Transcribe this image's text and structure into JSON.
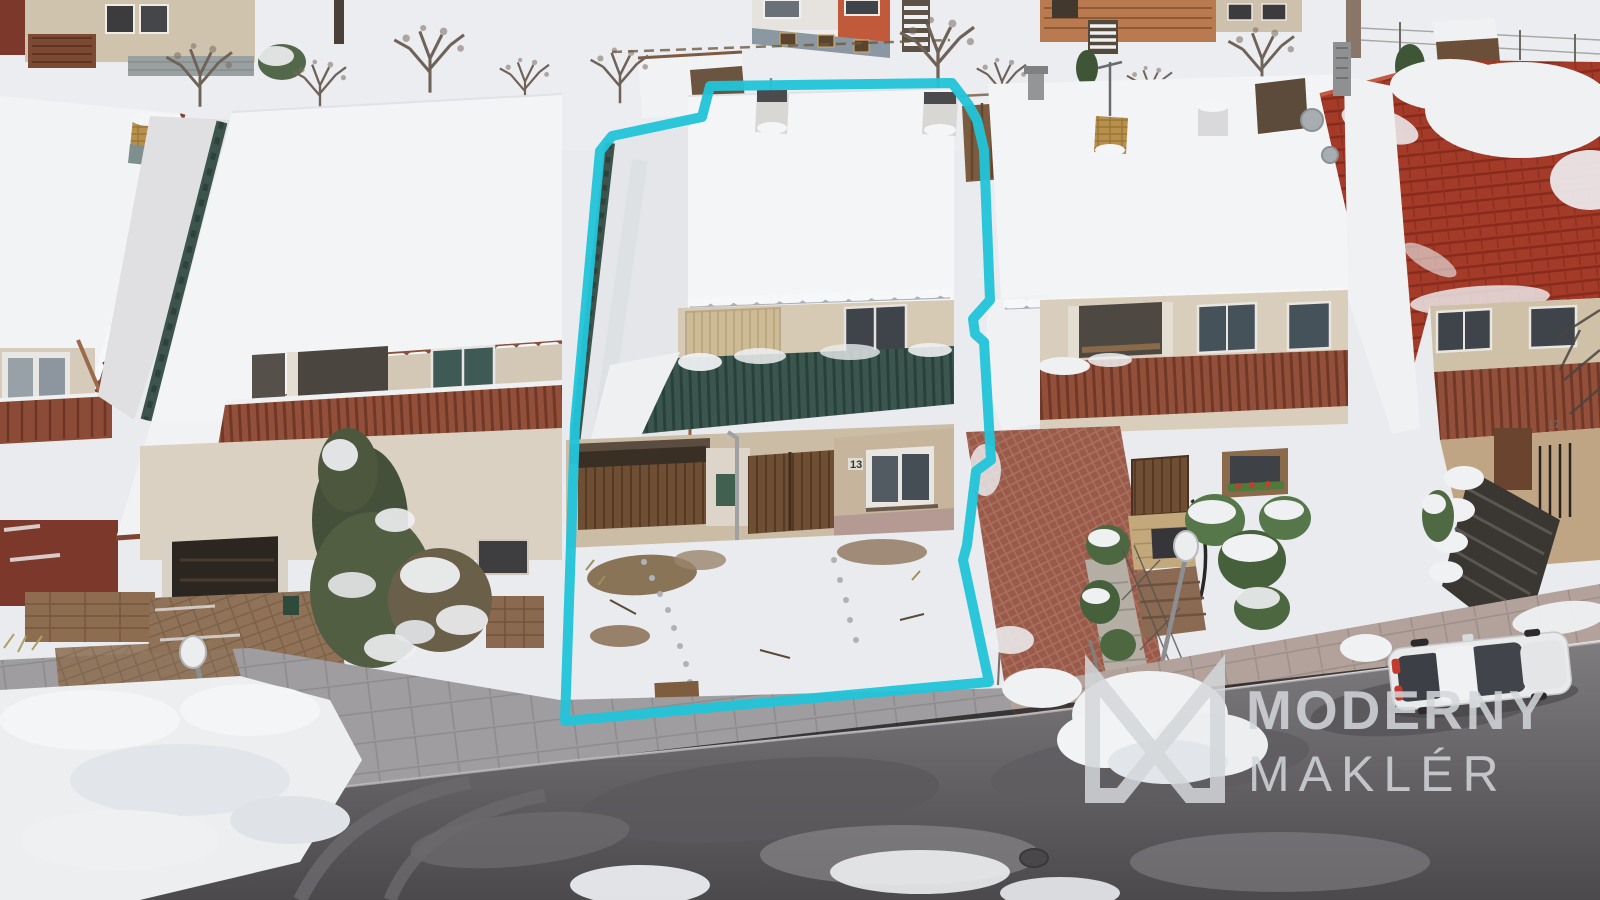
{
  "meta": {
    "kind": "aerial-real-estate-photo",
    "season": "winter-snow",
    "width": 1600,
    "height": 900
  },
  "watermark": {
    "logo": "m-monogram-icon",
    "brand_line1": "MODERNY",
    "brand_line2": "MAKLÉR",
    "color": "#d4d7da",
    "opacity": "0.85"
  },
  "property_outline": {
    "color": "#22c4d9",
    "stroke_width": "10",
    "points": "710,86 952,83 968,104 977,120 984,150 990,300 973,319 975,334 984,342 991,460 976,471 967,545 963,560 989,682 565,721 575,425 600,151 612,136 702,117"
  },
  "labels": {
    "house_number_center": "13",
    "house_number_right": "17"
  },
  "palette": {
    "snow": "#f2f3f5",
    "ground_snow": "#e9ebee",
    "asphalt_dark": "#4e4c4f",
    "asphalt_light": "#807e81",
    "red_roof": "#a43b29",
    "teal_railing": "#3b564e",
    "brown_fascia": "#7e4534",
    "highlight_cyan": "#22c4d9"
  }
}
